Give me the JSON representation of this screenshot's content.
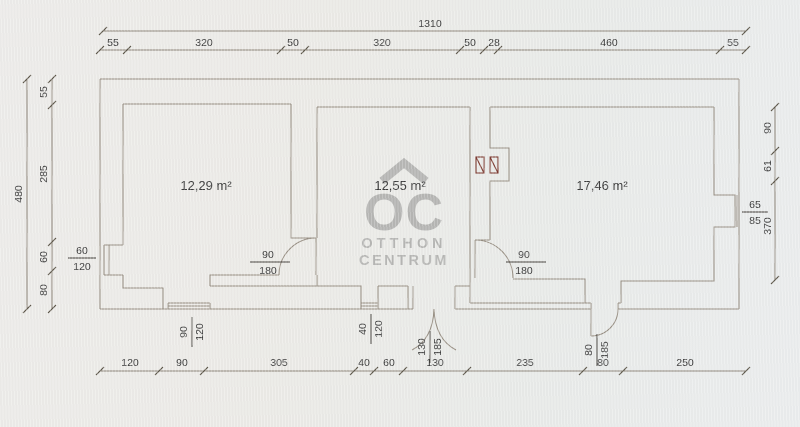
{
  "rooms": [
    {
      "area": "12,29 m²"
    },
    {
      "area": "12,55 m²"
    },
    {
      "area": "17,46 m²"
    }
  ],
  "dims": {
    "top_total": "1310",
    "top": [
      "55",
      "320",
      "50",
      "320",
      "50",
      "28",
      "460",
      "55"
    ],
    "left_total": "480",
    "left": [
      "55",
      "285",
      "60",
      "80"
    ],
    "right": [
      "90",
      "61",
      "370"
    ],
    "bottom": [
      "120",
      "90",
      "305",
      "40",
      "60",
      "130",
      "235",
      "80",
      "250"
    ]
  },
  "openings": {
    "left_window": {
      "num": "60",
      "den": "120"
    },
    "right_window": {
      "num": "65",
      "den": "85"
    },
    "room1_door": {
      "num": "90",
      "den": "180"
    },
    "room3_door": {
      "num": "90",
      "den": "180"
    },
    "bottom_window_left": {
      "num": "90",
      "den": "120"
    },
    "bottom_window_mid": {
      "num": "40",
      "den": "120"
    },
    "entrance_double_door": {
      "num": "130",
      "den": "185"
    },
    "bottom_right_door": {
      "num": "80",
      "den": "185"
    }
  },
  "watermark": {
    "monogram": "OC",
    "line1": "OTTHON",
    "line2": "CENTRUM"
  },
  "colors": {
    "background": "#ecebe7",
    "wall_line": "#968d81",
    "dimension_line": "#8d8579",
    "text": "#3a3a3a",
    "flue_symbol": "#7d3b31",
    "watermark": "#a8a8a6"
  }
}
